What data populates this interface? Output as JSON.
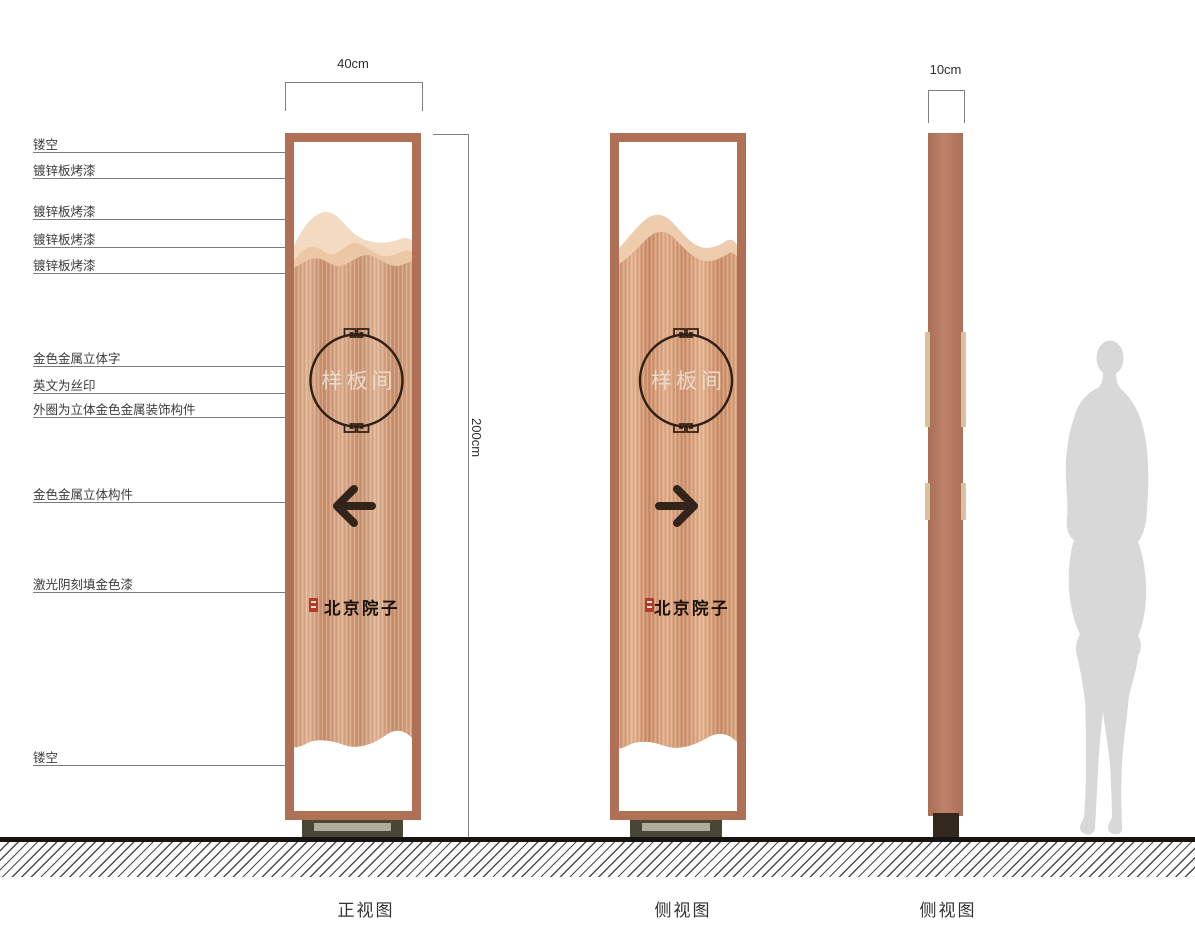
{
  "dimensions": {
    "width_label": "40cm",
    "height_label": "200cm",
    "depth_label": "10cm"
  },
  "captions": {
    "front": "正视图",
    "side": "侧视图",
    "profile": "侧视图"
  },
  "sign": {
    "panel_text": "样板间",
    "brand_text": "北京院子"
  },
  "annotations": [
    {
      "label": "镂空",
      "y": 152,
      "x_end": 302
    },
    {
      "label": "镀锌板烤漆",
      "y": 178,
      "x_end": 286
    },
    {
      "label": "镀锌板烤漆",
      "y": 219,
      "x_end": 321
    },
    {
      "label": "镀锌板烤漆",
      "y": 247,
      "x_end": 291
    },
    {
      "label": "镀锌板烤漆",
      "y": 273,
      "x_end": 290
    },
    {
      "label": "金色金属立体字",
      "y": 366,
      "x_end": 350
    },
    {
      "label": "英文为丝印",
      "y": 393,
      "x_end": 352
    },
    {
      "label": "外圈为立体金色金属装饰构件",
      "y": 417,
      "x_end": 356
    },
    {
      "label": "金色金属立体构件",
      "y": 502,
      "x_end": 348
    },
    {
      "label": "激光阴刻填金色漆",
      "y": 592,
      "x_end": 318
    },
    {
      "label": "镂空",
      "y": 765,
      "x_end": 302
    }
  ],
  "colors": {
    "frame": "#af7056",
    "tab_tan": "#d9c09e",
    "mountain_light": "#f3dac1",
    "mountain_mid": "#ecc7a6",
    "accent_dark": "#32241a",
    "seal_red": "#b43a2a",
    "panel_text_color": "#ece0d4",
    "silhouette": "#d8d8d8"
  }
}
